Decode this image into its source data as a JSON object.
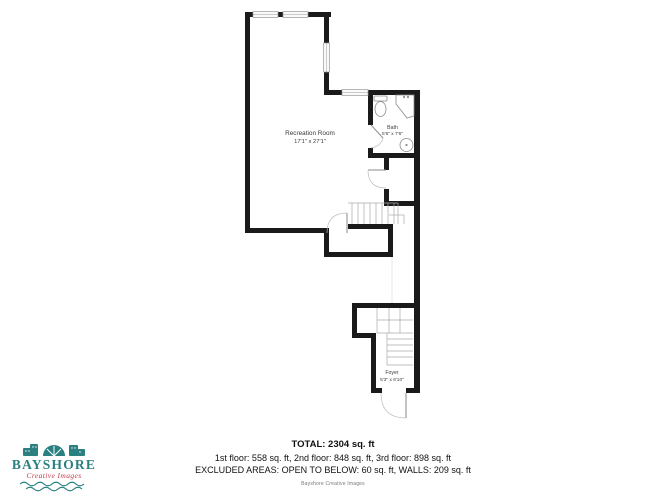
{
  "floorplan": {
    "rooms": [
      {
        "name": "Recreation Room",
        "dimensions": "17'1\" x 27'1\""
      },
      {
        "name": "Bath",
        "dimensions": "5'6\" x 7'6\""
      },
      {
        "name": "Foyer",
        "dimensions": "5'3\" x 6'10\""
      }
    ],
    "fixture_icons": [
      "toilet-icon",
      "shower-icon",
      "sink-icon",
      "door-swing-arc",
      "stairs",
      "window"
    ]
  },
  "summary": {
    "total": "TOTAL: 2304 sq. ft",
    "floors": "1st floor: 558 sq. ft, 2nd floor: 848 sq. ft, 3rd floor: 898 sq. ft",
    "excluded": "EXCLUDED AREAS: OPEN TO BELOW: 60 sq. ft, WALLS: 209 sq. ft"
  },
  "branding": {
    "logo_name": "BAYSHORE",
    "logo_tagline": "Creative Images",
    "footer_credit": "Bayshore Creative Images",
    "colors": {
      "teal": "#2a7f80",
      "red": "#c23b4a",
      "wall": "#1a1a1a"
    }
  }
}
